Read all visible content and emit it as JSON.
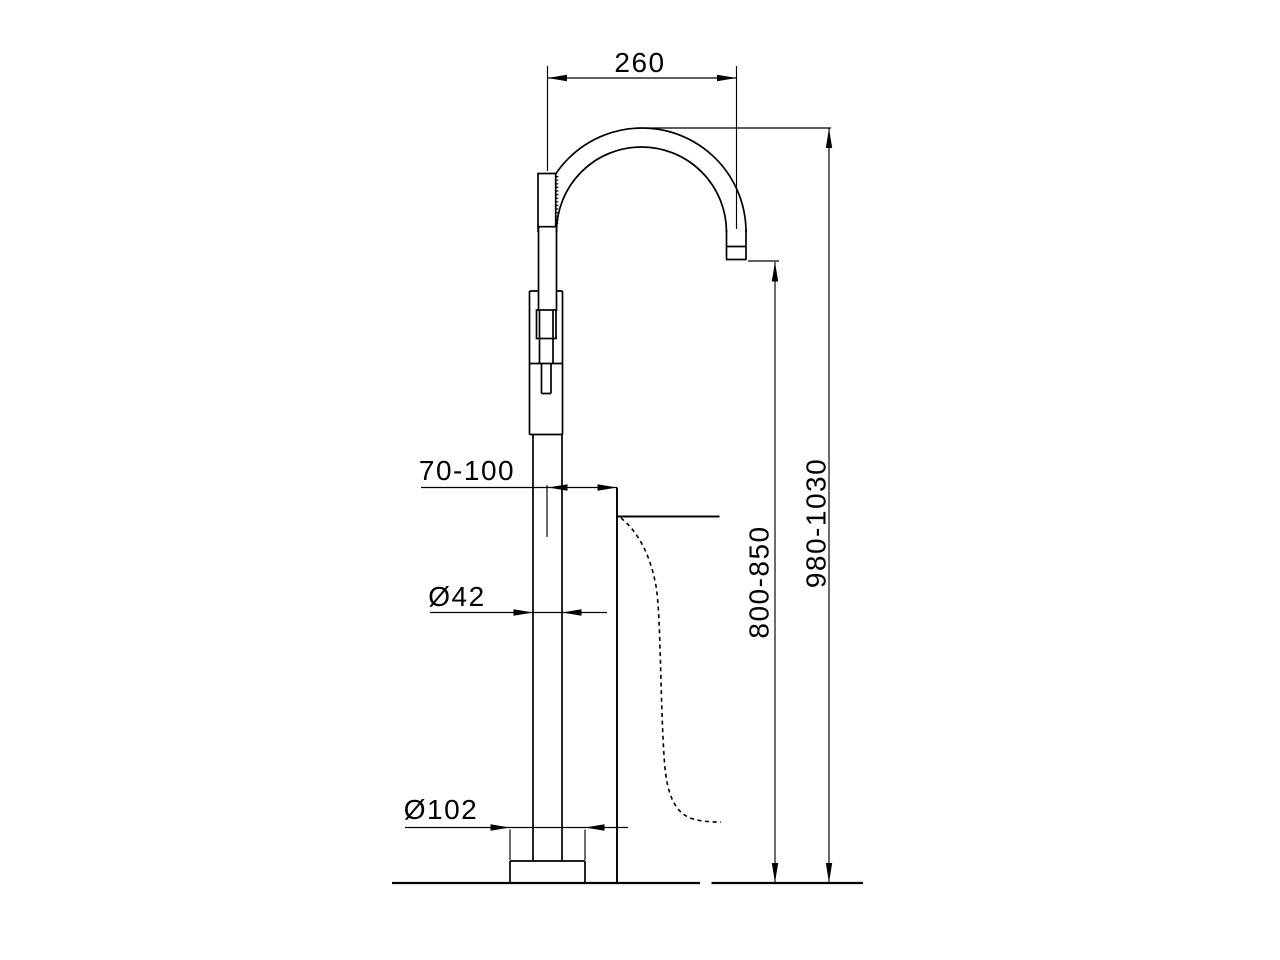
{
  "drawing": {
    "units": "mm",
    "style": {
      "line_color": "#000000",
      "background_color": "#ffffff"
    },
    "labels": {
      "spout_reach": "260",
      "tub_edge_offset": "70-100",
      "column_diameter": "Ø42",
      "base_diameter": "Ø102",
      "spout_outlet_height": "800-850",
      "overall_height": "980-1030"
    }
  }
}
